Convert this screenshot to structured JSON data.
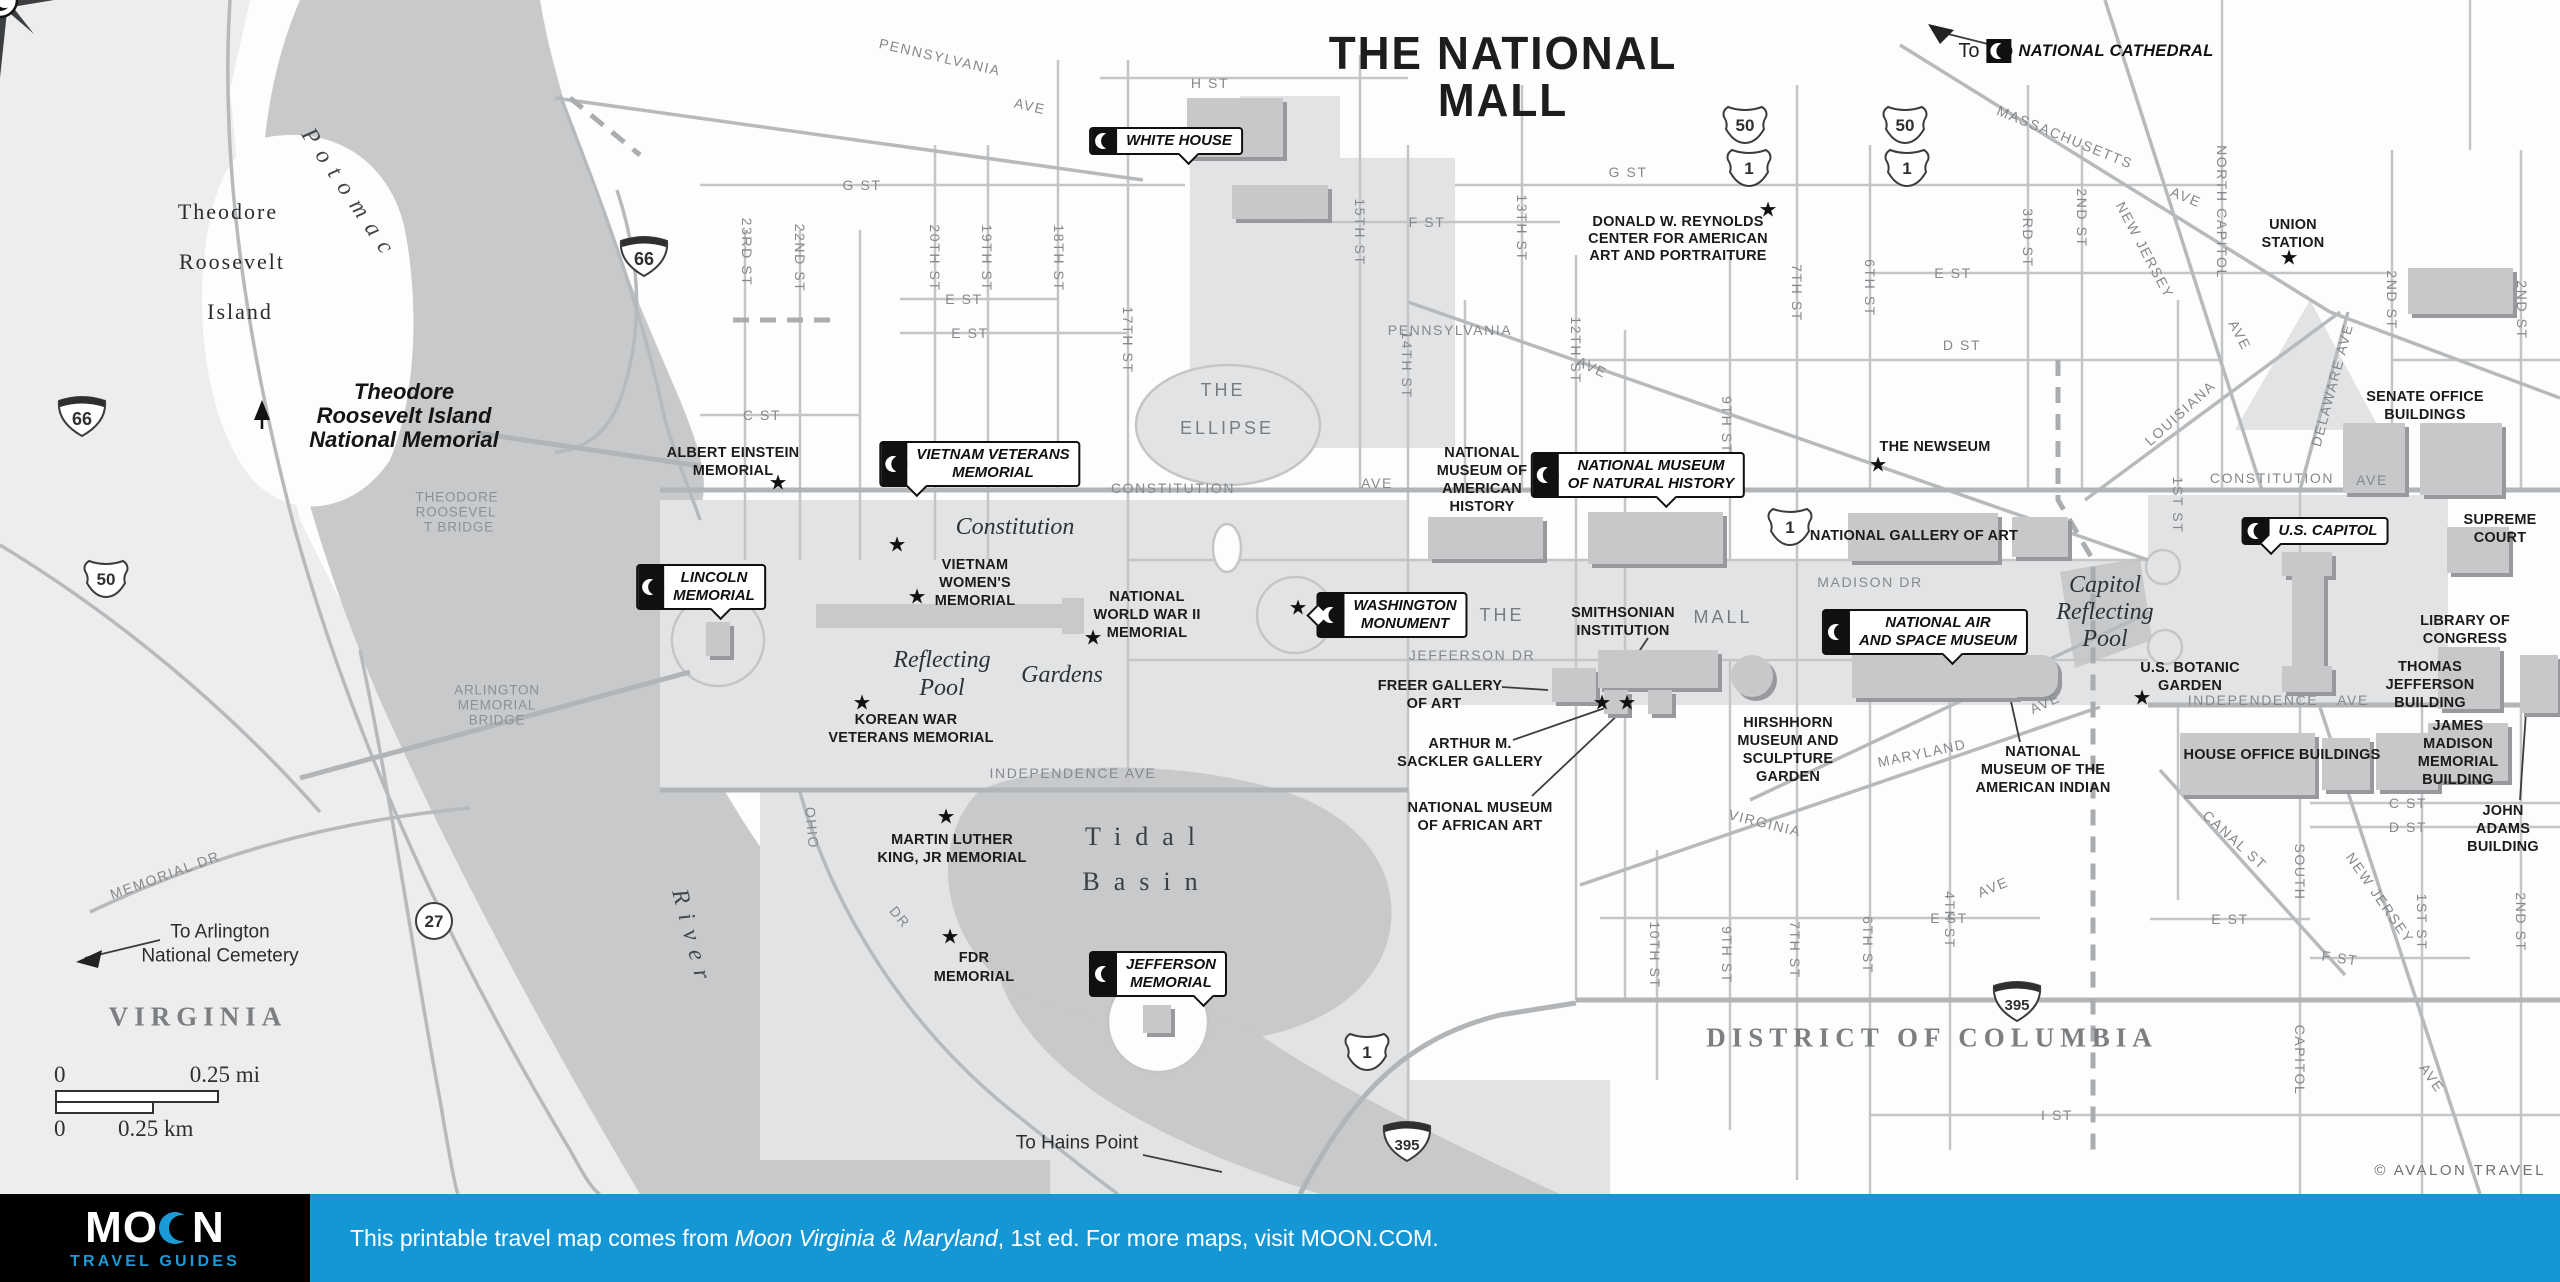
{
  "title": {
    "line1": "THE NATIONAL",
    "line2": "MALL"
  },
  "credit": "© AVALON TRAVEL",
  "cathedral": {
    "to": "To",
    "label": "NATIONAL CATHEDRAL"
  },
  "footer": {
    "logo_word": "MOON",
    "logo_sub": "TRAVEL GUIDES",
    "text_before": "This printable travel map comes from ",
    "book": "Moon Virginia & Maryland",
    "text_after": ", 1st ed. For more maps, visit MOON.COM.",
    "bar_color": "#1697d5",
    "logo_blue": "#1b9ad6"
  },
  "scale": {
    "mi0": "0",
    "mi": "0.25 mi",
    "km0": "0",
    "km": "0.25 km"
  },
  "colors": {
    "water": "#c7c9cb",
    "park": "#e2e3e4",
    "virginia_land": "#ededee",
    "road": "#c3c5c7",
    "accent_blue": "#1697d5"
  },
  "labels": [
    {
      "t": "PENNSYLVANIA",
      "x": 940,
      "y": 57,
      "c": "st",
      "r": 13
    },
    {
      "t": "AVE",
      "x": 1030,
      "y": 106,
      "c": "st",
      "r": 13
    },
    {
      "t": "H ST",
      "x": 1210,
      "y": 83,
      "c": "st"
    },
    {
      "t": "G ST",
      "x": 862,
      "y": 185,
      "c": "st"
    },
    {
      "t": "G ST",
      "x": 1628,
      "y": 172,
      "c": "st"
    },
    {
      "t": "F ST",
      "x": 1427,
      "y": 222,
      "c": "st"
    },
    {
      "t": "E ST",
      "x": 964,
      "y": 299,
      "c": "st"
    },
    {
      "t": "E ST",
      "x": 970,
      "y": 333,
      "c": "st"
    },
    {
      "t": "C ST",
      "x": 762,
      "y": 415,
      "c": "st"
    },
    {
      "t": "23RD ST",
      "x": 747,
      "y": 252,
      "c": "st",
      "r": 90
    },
    {
      "t": "22ND ST",
      "x": 800,
      "y": 258,
      "c": "st",
      "r": 90
    },
    {
      "t": "20TH ST",
      "x": 935,
      "y": 258,
      "c": "st",
      "r": 90
    },
    {
      "t": "19TH ST",
      "x": 987,
      "y": 258,
      "c": "st",
      "r": 90
    },
    {
      "t": "18TH ST",
      "x": 1059,
      "y": 258,
      "c": "st",
      "r": 90
    },
    {
      "t": "17TH ST",
      "x": 1128,
      "y": 340,
      "c": "st",
      "r": 90
    },
    {
      "t": "15TH ST",
      "x": 1360,
      "y": 232,
      "c": "st",
      "r": 90
    },
    {
      "t": "14TH ST",
      "x": 1407,
      "y": 365,
      "c": "st",
      "r": 90
    },
    {
      "t": "13TH ST",
      "x": 1522,
      "y": 228,
      "c": "st",
      "r": 90
    },
    {
      "t": "12TH ST",
      "x": 1576,
      "y": 350,
      "c": "st",
      "r": 90
    },
    {
      "t": "9TH ST",
      "x": 1727,
      "y": 425,
      "c": "st",
      "r": 90
    },
    {
      "t": "7TH ST",
      "x": 1797,
      "y": 293,
      "c": "st",
      "r": 90
    },
    {
      "t": "6TH ST",
      "x": 1870,
      "y": 288,
      "c": "st",
      "r": 90
    },
    {
      "t": "3RD ST",
      "x": 2028,
      "y": 238,
      "c": "st",
      "r": 90
    },
    {
      "t": "2ND ST",
      "x": 2082,
      "y": 218,
      "c": "st",
      "r": 90
    },
    {
      "t": "NORTH CAPITOL",
      "x": 2222,
      "y": 212,
      "c": "st",
      "r": 90
    },
    {
      "t": "2ND ST",
      "x": 2392,
      "y": 300,
      "c": "st",
      "r": 90
    },
    {
      "t": "2ND ST",
      "x": 2522,
      "y": 310,
      "c": "st",
      "r": 90
    },
    {
      "t": "MASSACHUSETTS",
      "x": 2065,
      "y": 137,
      "c": "st",
      "r": 22
    },
    {
      "t": "AVE",
      "x": 2186,
      "y": 197,
      "c": "st",
      "r": 22
    },
    {
      "t": "NEW JERSEY",
      "x": 2145,
      "y": 250,
      "c": "st",
      "r": 62
    },
    {
      "t": "AVE",
      "x": 2240,
      "y": 335,
      "c": "st",
      "r": 62
    },
    {
      "t": "DELAWARE AVE",
      "x": 2332,
      "y": 385,
      "c": "st",
      "r": -75
    },
    {
      "t": "LOUISIANA",
      "x": 2180,
      "y": 413,
      "c": "st",
      "r": -42
    },
    {
      "t": "1ST ST",
      "x": 2178,
      "y": 505,
      "c": "st",
      "r": 90
    },
    {
      "t": "E ST",
      "x": 1953,
      "y": 273,
      "c": "st"
    },
    {
      "t": "E ST",
      "x": 2230,
      "y": 919,
      "c": "st"
    },
    {
      "t": "D ST",
      "x": 1962,
      "y": 345,
      "c": "st"
    },
    {
      "t": "C ST",
      "x": 2408,
      "y": 803,
      "c": "st"
    },
    {
      "t": "D ST",
      "x": 2408,
      "y": 827,
      "c": "st"
    },
    {
      "t": "F ST",
      "x": 2340,
      "y": 958,
      "c": "st",
      "r": 8
    },
    {
      "t": "I ST",
      "x": 2057,
      "y": 1115,
      "c": "st"
    },
    {
      "t": "E ST",
      "x": 1949,
      "y": 918,
      "c": "st"
    },
    {
      "t": "AVE",
      "x": 1993,
      "y": 887,
      "c": "st",
      "r": -22
    },
    {
      "t": "PENNSYLVANIA",
      "x": 1450,
      "y": 330,
      "c": "st"
    },
    {
      "t": "AVE",
      "x": 1592,
      "y": 367,
      "c": "st",
      "r": 25
    },
    {
      "t": "CONSTITUTION",
      "x": 1173,
      "y": 488,
      "c": "st"
    },
    {
      "t": "AVE",
      "x": 1377,
      "y": 483,
      "c": "st"
    },
    {
      "t": "CONSTITUTION",
      "x": 2272,
      "y": 478,
      "c": "st"
    },
    {
      "t": "AVE",
      "x": 2372,
      "y": 480,
      "c": "st"
    },
    {
      "t": "MADISON DR",
      "x": 1870,
      "y": 582,
      "c": "st"
    },
    {
      "t": "JEFFERSON DR",
      "x": 1472,
      "y": 655,
      "c": "st"
    },
    {
      "t": "INDEPENDENCE AVE",
      "x": 1073,
      "y": 773,
      "c": "st"
    },
    {
      "t": "INDEPENDENCE",
      "x": 2253,
      "y": 700,
      "c": "st"
    },
    {
      "t": "AVE",
      "x": 2353,
      "y": 700,
      "c": "st"
    },
    {
      "t": "MARYLAND",
      "x": 1922,
      "y": 753,
      "c": "st",
      "r": -12
    },
    {
      "t": "AVE",
      "x": 2045,
      "y": 703,
      "c": "st",
      "r": -25
    },
    {
      "t": "VIRGINIA",
      "x": 1765,
      "y": 823,
      "c": "st",
      "r": 14
    },
    {
      "t": "CANAL ST",
      "x": 2235,
      "y": 840,
      "c": "st",
      "r": 42
    },
    {
      "t": "NEW JERSEY",
      "x": 2380,
      "y": 898,
      "c": "st",
      "r": 55
    },
    {
      "t": "AVE",
      "x": 2432,
      "y": 1078,
      "c": "st",
      "r": 55
    },
    {
      "t": "SOUTH",
      "x": 2300,
      "y": 872,
      "c": "st",
      "r": 90
    },
    {
      "t": "CAPITOL",
      "x": 2300,
      "y": 1060,
      "c": "st",
      "r": 90
    },
    {
      "t": "1ST ST",
      "x": 2422,
      "y": 922,
      "c": "st",
      "r": 90
    },
    {
      "t": "2ND ST",
      "x": 2521,
      "y": 922,
      "c": "st",
      "r": 90
    },
    {
      "t": "10TH ST",
      "x": 1655,
      "y": 955,
      "c": "st",
      "r": 90
    },
    {
      "t": "9TH ST",
      "x": 1727,
      "y": 955,
      "c": "st",
      "r": 90
    },
    {
      "t": "7TH ST",
      "x": 1795,
      "y": 950,
      "c": "st",
      "r": 90
    },
    {
      "t": "6TH ST",
      "x": 1868,
      "y": 945,
      "c": "st",
      "r": 90
    },
    {
      "t": "4TH ST",
      "x": 1950,
      "y": 920,
      "c": "st",
      "r": 90
    },
    {
      "t": "OHIO",
      "x": 812,
      "y": 828,
      "c": "st",
      "r": 85
    },
    {
      "t": "DR",
      "x": 900,
      "y": 917,
      "c": "st",
      "r": 50
    },
    {
      "t": "MEMORIAL DR",
      "x": 165,
      "y": 875,
      "c": "st",
      "r": -20
    },
    {
      "t": "THE",
      "x": 1502,
      "y": 615,
      "c": "stB"
    },
    {
      "t": "MALL",
      "x": 1723,
      "y": 617,
      "c": "stB"
    },
    {
      "t": "THE",
      "x": 1223,
      "y": 390,
      "c": "stB"
    },
    {
      "t": "ELLIPSE",
      "x": 1227,
      "y": 428,
      "c": "stB"
    },
    {
      "t": "ALBERT EINSTEIN",
      "x": 733,
      "y": 453,
      "c": "poi"
    },
    {
      "t": "MEMORIAL",
      "x": 733,
      "y": 471,
      "c": "poi"
    },
    {
      "t": "VIETNAM",
      "x": 975,
      "y": 565,
      "c": "poi"
    },
    {
      "t": "WOMEN'S",
      "x": 975,
      "y": 583,
      "c": "poi"
    },
    {
      "t": "MEMORIAL",
      "x": 975,
      "y": 601,
      "c": "poi"
    },
    {
      "t": "NATIONAL",
      "x": 1147,
      "y": 597,
      "c": "poi"
    },
    {
      "t": "WORLD WAR II",
      "x": 1147,
      "y": 615,
      "c": "poi"
    },
    {
      "t": "MEMORIAL",
      "x": 1147,
      "y": 633,
      "c": "poi"
    },
    {
      "t": "KOREAN WAR",
      "x": 906,
      "y": 720,
      "c": "poi"
    },
    {
      "t": "VETERANS MEMORIAL",
      "x": 911,
      "y": 738,
      "c": "poi"
    },
    {
      "t": "MARTIN LUTHER",
      "x": 952,
      "y": 840,
      "c": "poi"
    },
    {
      "t": "KING, JR MEMORIAL",
      "x": 952,
      "y": 858,
      "c": "poi"
    },
    {
      "t": "FDR",
      "x": 974,
      "y": 958,
      "c": "poi"
    },
    {
      "t": "MEMORIAL",
      "x": 974,
      "y": 977,
      "c": "poi"
    },
    {
      "t": "NATIONAL",
      "x": 1482,
      "y": 453,
      "c": "poi"
    },
    {
      "t": "MUSEUM OF",
      "x": 1482,
      "y": 471,
      "c": "poi"
    },
    {
      "t": "AMERICAN",
      "x": 1482,
      "y": 489,
      "c": "poi"
    },
    {
      "t": "HISTORY",
      "x": 1482,
      "y": 507,
      "c": "poi"
    },
    {
      "t": "DONALD W. REYNOLDS",
      "x": 1678,
      "y": 222,
      "c": "poi"
    },
    {
      "t": "CENTER FOR AMERICAN",
      "x": 1678,
      "y": 239,
      "c": "poi"
    },
    {
      "t": "ART AND PORTRAITURE",
      "x": 1678,
      "y": 256,
      "c": "poi"
    },
    {
      "t": "THE NEWSEUM",
      "x": 1935,
      "y": 447,
      "c": "poi"
    },
    {
      "t": "FREER GALLERY",
      "x": 1440,
      "y": 686,
      "c": "poi"
    },
    {
      "t": "OF ART",
      "x": 1434,
      "y": 704,
      "c": "poi"
    },
    {
      "t": "ARTHUR M.",
      "x": 1470,
      "y": 744,
      "c": "poi"
    },
    {
      "t": "SACKLER GALLERY",
      "x": 1470,
      "y": 762,
      "c": "poi"
    },
    {
      "t": "NATIONAL MUSEUM",
      "x": 1480,
      "y": 808,
      "c": "poi"
    },
    {
      "t": "OF AFRICAN ART",
      "x": 1480,
      "y": 826,
      "c": "poi"
    },
    {
      "t": "HIRSHHORN",
      "x": 1788,
      "y": 723,
      "c": "poi"
    },
    {
      "t": "MUSEUM AND",
      "x": 1788,
      "y": 741,
      "c": "poi"
    },
    {
      "t": "SCULPTURE",
      "x": 1788,
      "y": 759,
      "c": "poi"
    },
    {
      "t": "GARDEN",
      "x": 1788,
      "y": 777,
      "c": "poi"
    },
    {
      "t": "SMITHSONIAN",
      "x": 1623,
      "y": 613,
      "c": "poi"
    },
    {
      "t": "INSTITUTION",
      "x": 1623,
      "y": 631,
      "c": "poi"
    },
    {
      "t": "NATIONAL GALLERY OF ART",
      "x": 1914,
      "y": 536,
      "c": "poi"
    },
    {
      "t": "NATIONAL",
      "x": 2043,
      "y": 752,
      "c": "poi"
    },
    {
      "t": "MUSEUM OF THE",
      "x": 2043,
      "y": 770,
      "c": "poi"
    },
    {
      "t": "AMERICAN INDIAN",
      "x": 2043,
      "y": 788,
      "c": "poi"
    },
    {
      "t": "U.S. BOTANIC",
      "x": 2190,
      "y": 668,
      "c": "poi"
    },
    {
      "t": "GARDEN",
      "x": 2190,
      "y": 686,
      "c": "poi"
    },
    {
      "t": "SENATE OFFICE",
      "x": 2425,
      "y": 397,
      "c": "poi"
    },
    {
      "t": "BUILDINGS",
      "x": 2425,
      "y": 415,
      "c": "poi"
    },
    {
      "t": "SUPREME",
      "x": 2500,
      "y": 520,
      "c": "poi"
    },
    {
      "t": "COURT",
      "x": 2500,
      "y": 538,
      "c": "poi"
    },
    {
      "t": "LIBRARY OF",
      "x": 2465,
      "y": 621,
      "c": "poi"
    },
    {
      "t": "CONGRESS",
      "x": 2465,
      "y": 639,
      "c": "poi"
    },
    {
      "t": "THOMAS",
      "x": 2430,
      "y": 667,
      "c": "poi"
    },
    {
      "t": "JEFFERSON",
      "x": 2430,
      "y": 685,
      "c": "poi"
    },
    {
      "t": "BUILDING",
      "x": 2430,
      "y": 703,
      "c": "poi"
    },
    {
      "t": "JAMES",
      "x": 2458,
      "y": 726,
      "c": "poi"
    },
    {
      "t": "MADISON",
      "x": 2458,
      "y": 744,
      "c": "poi"
    },
    {
      "t": "MEMORIAL",
      "x": 2458,
      "y": 762,
      "c": "poi"
    },
    {
      "t": "BUILDING",
      "x": 2458,
      "y": 780,
      "c": "poi"
    },
    {
      "t": "JOHN",
      "x": 2503,
      "y": 811,
      "c": "poi"
    },
    {
      "t": "ADAMS",
      "x": 2503,
      "y": 829,
      "c": "poi"
    },
    {
      "t": "BUILDING",
      "x": 2503,
      "y": 847,
      "c": "poi"
    },
    {
      "t": "HOUSE OFFICE BUILDINGS",
      "x": 2282,
      "y": 755,
      "c": "poi"
    },
    {
      "t": "UNION",
      "x": 2293,
      "y": 225,
      "c": "poi"
    },
    {
      "t": "STATION",
      "x": 2293,
      "y": 243,
      "c": "poi"
    },
    {
      "t": "THEODORE",
      "x": 457,
      "y": 497,
      "c": "brg"
    },
    {
      "t": "ROOSEVEL",
      "x": 456,
      "y": 512,
      "c": "brg"
    },
    {
      "t": "T BRIDGE",
      "x": 459,
      "y": 527,
      "c": "brg"
    },
    {
      "t": "ARLINGTON",
      "x": 497,
      "y": 690,
      "c": "brg"
    },
    {
      "t": "MEMORIAL",
      "x": 497,
      "y": 705,
      "c": "brg"
    },
    {
      "t": "BRIDGE",
      "x": 497,
      "y": 720,
      "c": "brg"
    },
    {
      "t": "Potomac",
      "x": 350,
      "y": 195,
      "c": "wat",
      "r": 56
    },
    {
      "t": "River",
      "x": 692,
      "y": 939,
      "c": "wat",
      "r": 75
    },
    {
      "t": "Tidal",
      "x": 1147,
      "y": 837,
      "c": "wat2"
    },
    {
      "t": "Basin",
      "x": 1147,
      "y": 882,
      "c": "wat2"
    },
    {
      "t": "Reflecting",
      "x": 942,
      "y": 660,
      "c": "pk"
    },
    {
      "t": "Pool",
      "x": 942,
      "y": 688,
      "c": "pk"
    },
    {
      "t": "Constitution",
      "x": 1015,
      "y": 527,
      "c": "pk"
    },
    {
      "t": "Gardens",
      "x": 1062,
      "y": 675,
      "c": "pk"
    },
    {
      "t": "Capitol",
      "x": 2105,
      "y": 585,
      "c": "pk"
    },
    {
      "t": "Reflecting",
      "x": 2105,
      "y": 612,
      "c": "pk"
    },
    {
      "t": "Pool",
      "x": 2105,
      "y": 639,
      "c": "pk"
    },
    {
      "t": "VIRGINIA",
      "x": 198,
      "y": 1017,
      "c": "reg"
    },
    {
      "t": "DISTRICT OF COLUMBIA",
      "x": 1932,
      "y": 1038,
      "c": "reg"
    },
    {
      "t": "Theodore",
      "x": 228,
      "y": 212,
      "c": "isl"
    },
    {
      "t": "Roosevelt",
      "x": 232,
      "y": 262,
      "c": "isl"
    },
    {
      "t": "Island",
      "x": 240,
      "y": 312,
      "c": "isl"
    },
    {
      "t": "Theodore",
      "x": 404,
      "y": 392,
      "c": "mem"
    },
    {
      "t": "Roosevelt Island",
      "x": 404,
      "y": 416,
      "c": "mem"
    },
    {
      "t": "National Memorial",
      "x": 404,
      "y": 440,
      "c": "mem"
    },
    {
      "t": "To Arlington",
      "x": 220,
      "y": 932,
      "c": "to"
    },
    {
      "t": "National Cemetery",
      "x": 220,
      "y": 956,
      "c": "to"
    },
    {
      "t": "To Hains Point",
      "x": 1077,
      "y": 1143,
      "c": "to"
    }
  ],
  "callouts": [
    {
      "name": "white-house",
      "lines": [
        "WHITE HOUSE"
      ],
      "x": 1166,
      "y": 141,
      "tail": "down"
    },
    {
      "name": "vietnam-veterans-memorial",
      "lines": [
        "VIETNAM VETERANS",
        "MEMORIAL"
      ],
      "x": 980,
      "y": 464,
      "tail": "down-left"
    },
    {
      "name": "lincoln-memorial",
      "lines": [
        "LINCOLN",
        "MEMORIAL"
      ],
      "x": 701,
      "y": 587,
      "tail": "down"
    },
    {
      "name": "washington-monument",
      "lines": [
        "WASHINGTON",
        "MONUMENT"
      ],
      "x": 1392,
      "y": 615,
      "tail": "left"
    },
    {
      "name": "national-museum-of-natural-history",
      "lines": [
        "NATIONAL MUSEUM",
        "OF NATURAL HISTORY"
      ],
      "x": 1638,
      "y": 475,
      "tail": "down"
    },
    {
      "name": "national-air-and-space-museum",
      "lines": [
        "NATIONAL AIR",
        "AND SPACE MUSEUM"
      ],
      "x": 1925,
      "y": 632,
      "tail": "down"
    },
    {
      "name": "jefferson-memorial",
      "lines": [
        "JEFFERSON",
        "MEMORIAL"
      ],
      "x": 1158,
      "y": 974,
      "tail": "down-right"
    },
    {
      "name": "us-capitol",
      "lines": [
        "U.S. CAPITOL"
      ],
      "x": 2315,
      "y": 531,
      "tail": "down-left"
    }
  ],
  "shields": [
    {
      "kind": "interstate",
      "num": "66",
      "x": 617,
      "y": 232
    },
    {
      "kind": "interstate",
      "num": "66",
      "x": 55,
      "y": 392
    },
    {
      "kind": "us",
      "num": "50",
      "x": 83,
      "y": 557
    },
    {
      "kind": "us",
      "num": "50",
      "x": 1722,
      "y": 103
    },
    {
      "kind": "us",
      "num": "1",
      "x": 1726,
      "y": 146
    },
    {
      "kind": "us",
      "num": "50",
      "x": 1882,
      "y": 103
    },
    {
      "kind": "us",
      "num": "1",
      "x": 1884,
      "y": 146
    },
    {
      "kind": "us",
      "num": "1",
      "x": 1767,
      "y": 505
    },
    {
      "kind": "us",
      "num": "1",
      "x": 1344,
      "y": 1030
    },
    {
      "kind": "interstate",
      "num": "395",
      "x": 1380,
      "y": 1117
    },
    {
      "kind": "interstate",
      "num": "395",
      "x": 1990,
      "y": 977
    },
    {
      "kind": "circle",
      "num": "27",
      "x": 413,
      "y": 900
    }
  ],
  "stars": [
    {
      "x": 778,
      "y": 483
    },
    {
      "x": 897,
      "y": 545
    },
    {
      "x": 917,
      "y": 597
    },
    {
      "x": 1093,
      "y": 638
    },
    {
      "x": 862,
      "y": 703
    },
    {
      "x": 946,
      "y": 817
    },
    {
      "x": 950,
      "y": 937
    },
    {
      "x": 1298,
      "y": 608
    },
    {
      "x": 2142,
      "y": 698
    },
    {
      "x": 1768,
      "y": 210
    },
    {
      "x": 1878,
      "y": 465
    },
    {
      "x": 2289,
      "y": 258
    },
    {
      "x": 1602,
      "y": 703
    },
    {
      "x": 1627,
      "y": 703
    }
  ]
}
